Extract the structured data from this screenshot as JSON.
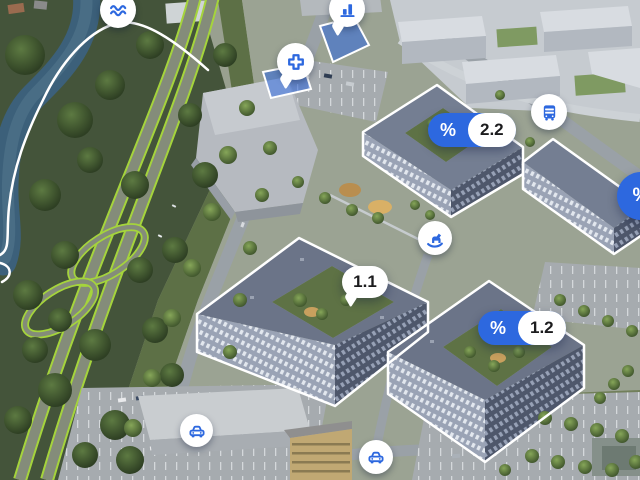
{
  "view": {
    "name": "Residential complex aerial masterplan",
    "type": "interactive-map"
  },
  "theme": {
    "accent_blue": "#2d68df",
    "marker_white": "#ffffff",
    "building_outline_white": "#ffffff",
    "route_green": "#a5d43c",
    "label_text_dark": "#1c1c1e"
  },
  "pins": {
    "water": {
      "icon": "waves-icon"
    },
    "commerce": {
      "icon": "bar-chart-icon"
    },
    "medical": {
      "icon": "medical-cross-icon"
    },
    "bus_stop": {
      "icon": "bus-icon"
    },
    "playground": {
      "icon": "rocking-horse-icon"
    },
    "parking_west": {
      "icon": "car-icon"
    },
    "parking_south": {
      "icon": "car-icon"
    }
  },
  "badges": {
    "offer_2_2": {
      "percent": "%",
      "value": "2.2"
    },
    "block_1_1": {
      "value": "1.1"
    },
    "offer_1_2": {
      "percent": "%",
      "value": "1.2"
    },
    "offer_edge": {
      "percent": "%"
    }
  }
}
